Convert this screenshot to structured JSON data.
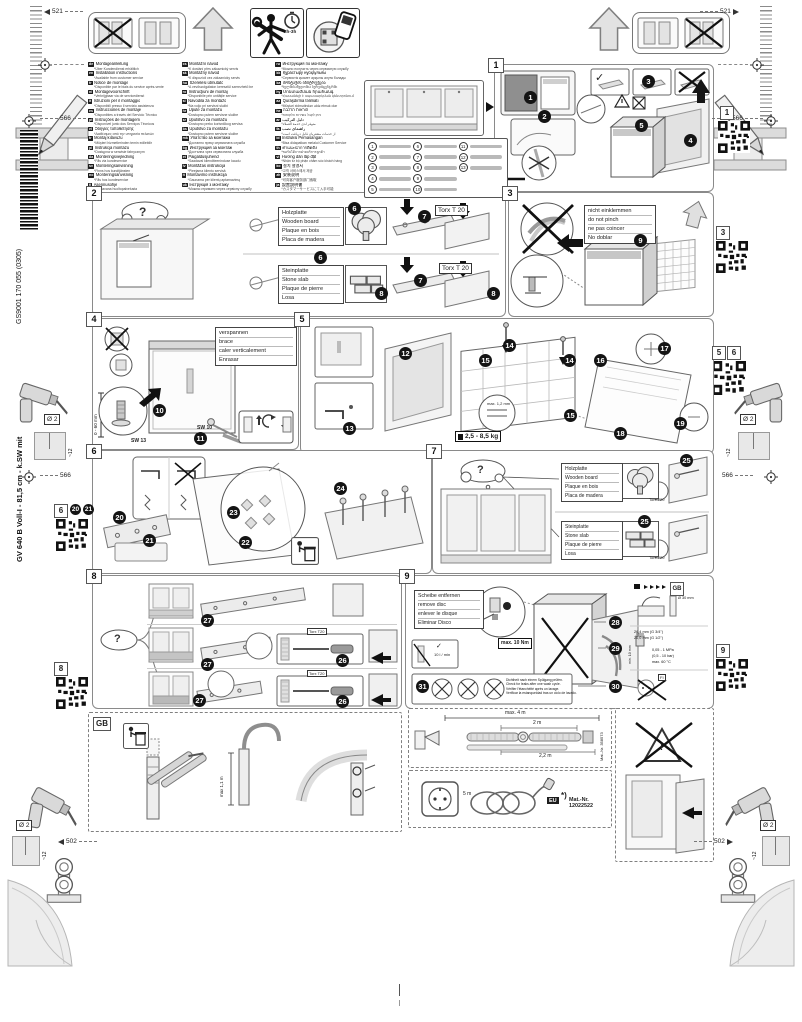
{
  "doc": {
    "product_line": "GV 640 B Voll-I - 81,5 cm - k.SW mit",
    "print_code": "GS9001 170 055 (0305)"
  },
  "dims": {
    "top_left": "521",
    "top_right": "521",
    "left_upper": "566",
    "right_upper": "566",
    "left_mid": "566",
    "right_mid": "566",
    "bottom_left": "502",
    "bottom_right": "502",
    "drill_dia": "Ø 2",
    "drill_depth": "~12"
  },
  "header": {
    "time": "2h-3h"
  },
  "misc": {
    "q": "?",
    "check": "✓",
    "cross": "✗",
    "warn": "!",
    "gb": "GB",
    "fi": "FI",
    "eu": "EU",
    "star": "*)"
  },
  "steps": {
    "s1": "1",
    "s2": "2",
    "s3": "3",
    "s4": "4",
    "s5": "5",
    "s6": "6",
    "s7": "7",
    "s8": "8",
    "s9": "9"
  },
  "badges": {
    "n1": "1",
    "n2": "2",
    "n3": "3",
    "n4": "4",
    "n5": "5",
    "n6": "6",
    "n7": "7",
    "n8": "8",
    "n9": "9",
    "n10": "10",
    "n11": "11",
    "n12": "12",
    "n13": "13",
    "n14": "14",
    "n15": "15",
    "n16": "16",
    "n17": "17",
    "n18": "18",
    "n19": "19",
    "n20": "20",
    "n21": "21",
    "n22": "22",
    "n23": "23",
    "n24": "24",
    "n25": "25",
    "n26": "26",
    "n27": "27",
    "n28": "28",
    "n29": "29",
    "n30": "30",
    "n31": "31"
  },
  "labels": {
    "wood": [
      "Holzplatte",
      "Wooden board",
      "Plaque en bois",
      "Placa de madera"
    ],
    "stone": [
      "Steinplatte",
      "Stone slab",
      "Plaque de pierre",
      "Losa"
    ],
    "pinch": [
      "nicht einklemmen",
      "do not pinch",
      "ne pas coincer",
      "No doblar"
    ],
    "brace": [
      "verspannen",
      "brace",
      "caler verticalement",
      "Enrasar"
    ],
    "disc": [
      "Scheibe entfernen",
      "remove disc",
      "enlever le disque",
      "Eliminar Disco"
    ],
    "leak": [
      "Dichtheit nach einem Spülgang prüfen.",
      "Check for leaks after one wash cycle.",
      "Vérifier l'étanchéité après un lavage.",
      "Verificar la estanqueidad tras un ciclo de lavado."
    ]
  },
  "tools": {
    "torx": "Torx T 20",
    "torx_s": "Torx T20",
    "sw13": "SW 13",
    "sw10": "SW 10"
  },
  "values": {
    "range": "0 - 60 mm",
    "weight": "2,5 - 8,5 kg",
    "gap": "max. 1,2 mm",
    "torque": "max. 10 Nm",
    "flow": "10 l / min",
    "standpipe": "Ø 30 mm",
    "conn34": "26,4 mm (G 3/4\")",
    "conn12": "20,0 mm (G 1/2\")",
    "clearance": "min. 10 mm",
    "pressure": "0,05 - 1 MPa",
    "pressure2": "(0,5 - 10 bar)",
    "temp": "max. 60 °C",
    "gb_hose": "max 1,1 m",
    "hose_max": "max. 4 m",
    "hose_2m": "2 m",
    "hose_22m": "2,2 m",
    "hose_part": "Mat.-Nr. 358573",
    "cord": "5 m",
    "power_part": "Mat.-Nr. 12022522"
  },
  "parts": {
    "items": [
      {
        "no": "1"
      },
      {
        "no": "2"
      },
      {
        "no": "3"
      },
      {
        "no": "4"
      },
      {
        "no": "5"
      },
      {
        "no": "6"
      },
      {
        "no": "7"
      },
      {
        "no": "8"
      },
      {
        "no": "9"
      },
      {
        "no": "10"
      },
      {
        "no": "11"
      },
      {
        "no": "12"
      },
      {
        "no": "13"
      }
    ]
  },
  "languages": {
    "col1": [
      {
        "c": "de",
        "t": "Montageanleitung",
        "n": "*Über Kundendienst erhältlich"
      },
      {
        "c": "en",
        "t": "Installation instructions",
        "n": "*Available from customer service"
      },
      {
        "c": "fr",
        "t": "Notice de montage",
        "n": "*Disponible par le biais du service après-vente"
      },
      {
        "c": "nl",
        "t": "Montagevoorschrift",
        "n": "*Verkrijgbaar via de servicedienst"
      },
      {
        "c": "it",
        "t": "Istruzioni per il montaggio",
        "n": "*Disponibili presso il servizio assistenza"
      },
      {
        "c": "es",
        "t": "Instrucciones de montaje",
        "n": "*Disponibles a través del Servicio Técnico"
      },
      {
        "c": "pt",
        "t": "Instruções de montagem",
        "n": "*Disponível junto dos Serviços Técnicos"
      },
      {
        "c": "el",
        "t": "Οδηγίες τοποθέτησης",
        "n": "*Διαθέσιμες από την υπηρεσία πελατών"
      },
      {
        "c": "tr",
        "t": "Montaj kılavuzu",
        "n": "*Müşteri hizmetlerinden temin edilebilir"
      },
      {
        "c": "pl",
        "t": "Instrukcja montażu",
        "n": "*Dostępna w serwisie fabrycznym"
      },
      {
        "c": "da",
        "t": "Monteringsvejledning",
        "n": "*Fås via kundeservice"
      },
      {
        "c": "sv",
        "t": "Monteringsanvisning",
        "n": "*Finns hos kundtjänsten"
      },
      {
        "c": "no",
        "t": "Monteringsanvisning",
        "n": "*Fås hos kundeservice"
      },
      {
        "c": "fi",
        "t": "Asennusohje",
        "n": "*Saatavana huoltopalvelusta"
      }
    ],
    "col2": [
      {
        "c": "cs",
        "t": "Montážní návod",
        "n": "*K dostání přes zákaznický servis"
      },
      {
        "c": "sk",
        "t": "Montážny návod",
        "n": "*K dispozícii cez zákaznícky servis"
      },
      {
        "c": "hu",
        "t": "Szerelési útmutató",
        "n": "*A vevőszolgálaton keresztül szerezhető be"
      },
      {
        "c": "ro",
        "t": "Instrucţiuni de montaj",
        "n": "*Disponibile prin unităţile service"
      },
      {
        "c": "sl",
        "t": "Navodila za montažo",
        "n": "*Na voljo pri servisni službi"
      },
      {
        "c": "hr",
        "t": "Upute za montažu",
        "n": "*Dostupno putem servisne službe"
      },
      {
        "c": "sr",
        "t": "Uputstvo za montažu",
        "n": "*Dostupno preko korisničkog servisa"
      },
      {
        "c": "bs",
        "t": "Uputstvo za montažu",
        "n": "*Dostupno putem servisne službe"
      },
      {
        "c": "mk",
        "t": "Упатство за монтажа",
        "n": "*Достапно преку сервисната служба"
      },
      {
        "c": "bg",
        "t": "Инструкция за монтаж",
        "n": "*Достъпна чрез сервизната служба"
      },
      {
        "c": "et",
        "t": "Paigaldusjuhend",
        "n": "*Saadaval klienditeeninduse kaudu"
      },
      {
        "c": "lv",
        "t": "Montāžas instrukcija",
        "n": "*Pieejama klientu servisā"
      },
      {
        "c": "lt",
        "t": "Montavimo instrukcija",
        "n": "*Gaunama per klientų aptarnavimą"
      },
      {
        "c": "uk",
        "t": "Інструкція з монтажу",
        "n": "*Можна отримати через сервісну службу"
      }
    ],
    "col3": [
      {
        "c": "ru",
        "t": "Инструкция по монтажу",
        "n": "*Можно получить через сервисную службу"
      },
      {
        "c": "kk",
        "t": "Құрастыру нұсқаулығы",
        "n": "*Сервистік қызмет арқылы алуға болады"
      },
      {
        "c": "ka",
        "t": "მონტაჟის ინსტრუქცია",
        "n": "*ხელმისაწვდომია სერვისცენტრში"
      },
      {
        "c": "hy",
        "t": "Մոնտաժման հրահանգ",
        "n": "*Հասանելի է սպասարկման կենտրոնում"
      },
      {
        "c": "az",
        "t": "Quraşdırma təlimatı",
        "n": "*Müştəri xidmətindən əldə etmək olar"
      },
      {
        "c": "he",
        "t": "הוראות הרכבה",
        "n": "*ניתן לקבל בשירות הלקוחות"
      },
      {
        "c": "ar",
        "t": "دليل التركيب",
        "n": "*متوفر لدى خدمة العملاء"
      },
      {
        "c": "fa",
        "t": "راهنمای نصب",
        "n": "*از خدمات مشتریان قابل دریافت است"
      },
      {
        "c": "id",
        "t": "Instruksi Pemasangan",
        "n": "*Bisa didapatkan melalui Customer Service"
      },
      {
        "c": "th",
        "t": "คำแนะนำการติดตั้ง",
        "n": "*ขอรับได้จากฝ่ายบริการลูกค้า"
      },
      {
        "c": "vi",
        "t": "Hướng dẫn lắp đặt",
        "n": "*Nhận từ bộ phận chăm sóc khách hàng"
      },
      {
        "c": "ko",
        "t": "설치 설명서",
        "n": "*고객 서비스에서 제공"
      },
      {
        "c": "zh",
        "t": "安装说明",
        "n": "*可向客户服务部门索取"
      },
      {
        "c": "ja",
        "t": "設置説明書",
        "n": "*カスタマーサービスにて入手可能"
      }
    ]
  }
}
